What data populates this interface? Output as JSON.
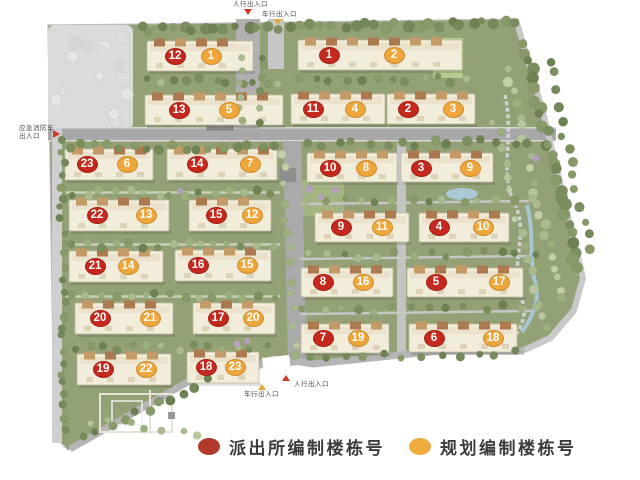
{
  "colors": {
    "police_red": "#c5291e",
    "planning_orange": "#efa63a",
    "arrow_red": "#cf3a28",
    "arrow_orange": "#e9a63c"
  },
  "legend": {
    "items": [
      {
        "label": "派出所编制楼栋号",
        "color": "#b23a2b"
      },
      {
        "label": "规划编制楼栋号",
        "color": "#eeac3f"
      }
    ]
  },
  "entrances": {
    "top_pedestrian": {
      "label": "人行出入口",
      "arrow": "red",
      "direction": "down"
    },
    "top_vehicle": {
      "label": "车行出入口",
      "arrow": "orange",
      "direction": "down"
    },
    "left_emergency": {
      "line1": "应急消防车",
      "line2": "出入口",
      "arrow": "red",
      "direction": "right"
    },
    "bottom_pedestrian": {
      "label": "人行出入口",
      "arrow": "red",
      "direction": "up"
    },
    "bottom_vehicle": {
      "label": "车行出入口",
      "arrow": "orange",
      "direction": "up"
    }
  },
  "buildings": [
    {
      "police": "12",
      "planning": "1",
      "bx": 147,
      "by": 41,
      "bw": 106,
      "bh": 30,
      "px": 175,
      "py": 56,
      "ox": 211,
      "oy": 56
    },
    {
      "police": "1",
      "planning": "2",
      "bx": 298,
      "by": 40,
      "bw": 164,
      "bh": 30,
      "px": 329,
      "py": 55,
      "ox": 394,
      "oy": 55
    },
    {
      "police": "13",
      "planning": "5",
      "bx": 145,
      "by": 95,
      "bw": 138,
      "bh": 30,
      "px": 179,
      "py": 110,
      "ox": 229,
      "oy": 110
    },
    {
      "police": "11",
      "planning": "4",
      "bx": 291,
      "by": 94,
      "bw": 94,
      "bh": 30,
      "px": 313,
      "py": 109,
      "ox": 355,
      "oy": 109
    },
    {
      "police": "2",
      "planning": "3",
      "bx": 387,
      "by": 94,
      "bw": 88,
      "bh": 30,
      "px": 408,
      "py": 109,
      "ox": 453,
      "oy": 109
    },
    {
      "police": "23",
      "planning": "6",
      "bx": 65,
      "by": 149,
      "bw": 88,
      "bh": 31,
      "px": 87,
      "py": 164,
      "ox": 127,
      "oy": 164
    },
    {
      "police": "14",
      "planning": "7",
      "bx": 167,
      "by": 149,
      "bw": 110,
      "bh": 31,
      "px": 197,
      "py": 164,
      "ox": 250,
      "oy": 164
    },
    {
      "police": "10",
      "planning": "8",
      "bx": 307,
      "by": 153,
      "bw": 90,
      "bh": 29,
      "px": 330,
      "py": 168,
      "ox": 366,
      "oy": 168
    },
    {
      "police": "3",
      "planning": "9",
      "bx": 401,
      "by": 153,
      "bw": 92,
      "bh": 29,
      "px": 421,
      "py": 168,
      "ox": 470,
      "oy": 168
    },
    {
      "police": "22",
      "planning": "13",
      "bx": 69,
      "by": 200,
      "bw": 100,
      "bh": 31,
      "px": 97,
      "py": 215,
      "ox": 146,
      "oy": 215
    },
    {
      "police": "15",
      "planning": "12",
      "bx": 189,
      "by": 200,
      "bw": 82,
      "bh": 31,
      "px": 216,
      "py": 215,
      "ox": 252,
      "oy": 215
    },
    {
      "police": "9",
      "planning": "11",
      "bx": 315,
      "by": 213,
      "bw": 94,
      "bh": 29,
      "px": 341,
      "py": 227,
      "ox": 382,
      "oy": 227
    },
    {
      "police": "4",
      "planning": "10",
      "bx": 419,
      "by": 213,
      "bw": 90,
      "bh": 29,
      "px": 439,
      "py": 227,
      "ox": 483,
      "oy": 227
    },
    {
      "police": "21",
      "planning": "14",
      "bx": 69,
      "by": 251,
      "bw": 94,
      "bh": 31,
      "px": 95,
      "py": 266,
      "ox": 128,
      "oy": 266
    },
    {
      "police": "16",
      "planning": "15",
      "bx": 175,
      "by": 250,
      "bw": 96,
      "bh": 31,
      "px": 198,
      "py": 265,
      "ox": 247,
      "oy": 265
    },
    {
      "police": "8",
      "planning": "16",
      "bx": 301,
      "by": 268,
      "bw": 92,
      "bh": 29,
      "px": 323,
      "py": 282,
      "ox": 363,
      "oy": 282
    },
    {
      "police": "5",
      "planning": "17",
      "bx": 407,
      "by": 268,
      "bw": 116,
      "bh": 29,
      "px": 436,
      "py": 282,
      "ox": 499,
      "oy": 282
    },
    {
      "police": "20",
      "planning": "21",
      "bx": 75,
      "by": 303,
      "bw": 98,
      "bh": 31,
      "px": 100,
      "py": 318,
      "ox": 150,
      "oy": 318
    },
    {
      "police": "17",
      "planning": "20",
      "bx": 193,
      "by": 303,
      "bw": 82,
      "bh": 31,
      "px": 218,
      "py": 318,
      "ox": 253,
      "oy": 318
    },
    {
      "police": "7",
      "planning": "19",
      "bx": 301,
      "by": 324,
      "bw": 88,
      "bh": 29,
      "px": 323,
      "py": 338,
      "ox": 358,
      "oy": 338
    },
    {
      "police": "6",
      "planning": "18",
      "bx": 409,
      "by": 324,
      "bw": 108,
      "bh": 28,
      "px": 434,
      "py": 338,
      "ox": 493,
      "oy": 338
    },
    {
      "police": "19",
      "planning": "22",
      "bx": 77,
      "by": 354,
      "bw": 94,
      "bh": 31,
      "px": 103,
      "py": 369,
      "ox": 146,
      "oy": 369
    },
    {
      "police": "18",
      "planning": "23",
      "bx": 187,
      "by": 352,
      "bw": 72,
      "bh": 31,
      "px": 206,
      "py": 367,
      "ox": 235,
      "oy": 367
    }
  ]
}
